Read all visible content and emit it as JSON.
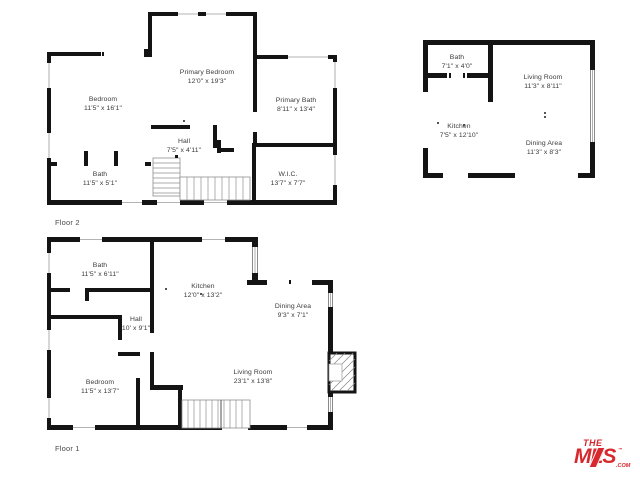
{
  "colors": {
    "wall": "#141414",
    "label_text": "#3a3a3a",
    "brand_red": "#d7282e",
    "window_line": "#9a9a9a"
  },
  "floor2": {
    "caption": "Floor 2",
    "rooms": [
      {
        "name": "Bedroom",
        "dims": "11'5\" x 16'1\""
      },
      {
        "name": "Primary Bedroom",
        "dims": "12'0\" x 19'3\""
      },
      {
        "name": "Primary Bath",
        "dims": "8'11\" x 13'4\""
      },
      {
        "name": "Hall",
        "dims": "7'5\" x 4'11\""
      },
      {
        "name": "Bath",
        "dims": "11'5\" x 5'1\""
      },
      {
        "name": "W.I.C.",
        "dims": "13'7\" x 7'7\""
      }
    ]
  },
  "unit": {
    "rooms": [
      {
        "name": "Bath",
        "dims": "7'1\" x 4'0\""
      },
      {
        "name": "Living Room",
        "dims": "11'3\" x 8'11\""
      },
      {
        "name": "Kitchen",
        "dims": "7'5\" x 12'10\""
      },
      {
        "name": "Dining Area",
        "dims": "11'3\" x 8'3\""
      }
    ]
  },
  "floor1": {
    "caption": "Floor 1",
    "rooms": [
      {
        "name": "Bath",
        "dims": "11'5\" x 6'11\""
      },
      {
        "name": "Kitchen",
        "dims": "12'0\" x 13'2\""
      },
      {
        "name": "Dining Area",
        "dims": "9'3\" x 7'1\""
      },
      {
        "name": "Hall",
        "dims": "10' x 9'1\""
      },
      {
        "name": "Bedroom",
        "dims": "11'5\" x 13'7\""
      },
      {
        "name": "Living Room",
        "dims": "23'1\" x 13'8\""
      }
    ]
  },
  "logo": {
    "the": "THE",
    "mls": "MLS",
    "tm": "™",
    "com": ".COM"
  }
}
